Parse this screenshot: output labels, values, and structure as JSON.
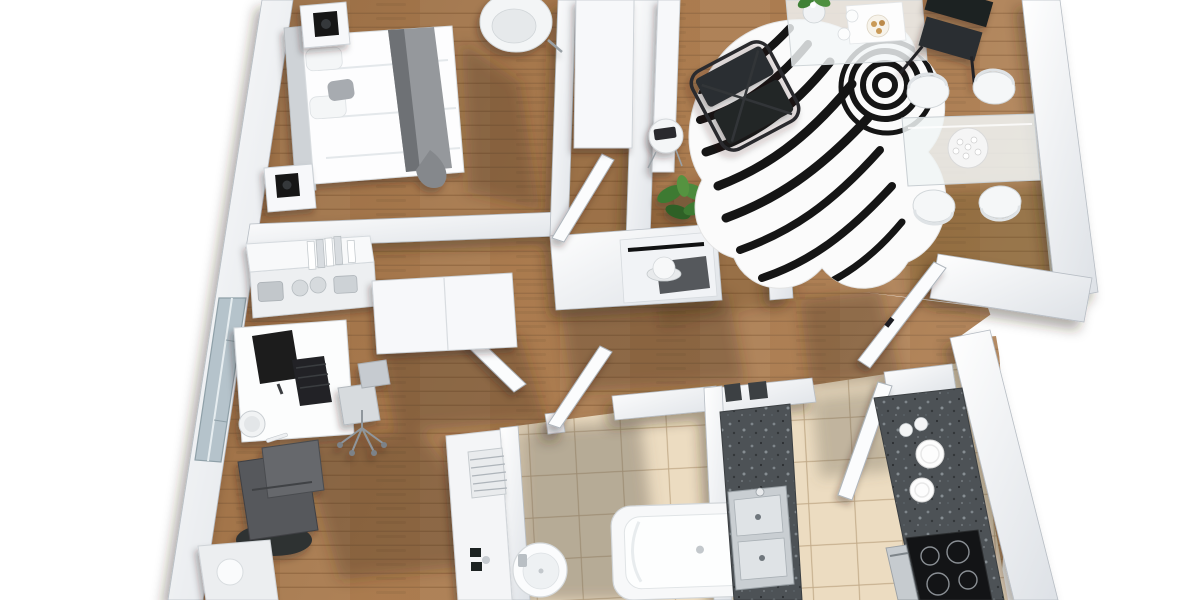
{
  "meta": {
    "title": "3D apartment floor plan render",
    "view": "top-down perspective, no visible text or UI chrome",
    "background": "#ffffff"
  },
  "colors": {
    "wood": "#ad7d50",
    "woodDark": "#8f6237",
    "tile": "#ecdcc1",
    "tileLine": "#c9b28b",
    "wall": "#f5f6f8",
    "wallEdge": "#b7bdc4",
    "granite": "#4d5256",
    "dark": "#1b1d1f",
    "chrome": "#aab1b7",
    "plant": "#3e7a33",
    "zebraBlack": "#151515",
    "shadowWood": "rgba(66,44,22,0.30)",
    "shadowTile": "rgba(104,96,82,0.40)"
  },
  "scene": {
    "rooms": [
      {
        "name": "bedroom",
        "floor": "wood",
        "furniture": [
          "double-bed-white-duvet",
          "gray-throw-blanket",
          "pillows",
          "upholstered-headboard",
          "nightstand-with-black-lamp-x2",
          "white-armchair"
        ]
      },
      {
        "name": "home-office",
        "floor": "wood",
        "furniture": [
          "white-desk",
          "monitor",
          "keyboard",
          "desk-bowl",
          "office-chair",
          "wall-shelf-with-binders-and-baskets",
          "wardrobe-with-open-door",
          "dark-lounge-chair",
          "low-cabinet",
          "window-in-west-wall"
        ]
      },
      {
        "name": "living-room",
        "floor": "wood",
        "furniture": [
          "zebra-hide-rug",
          "glass-coffee-table",
          "flower-vase",
          "serving-tray-with-plate-and-cups",
          "black-tubular-lounge-chair",
          "black-folding-chair",
          "potted-plant",
          "wall-console",
          "round-side-table"
        ]
      },
      {
        "name": "dining-area",
        "floor": "wood",
        "furniture": [
          "glass-dining-table",
          "white-shell-chair-x4",
          "coral-centerpiece"
        ]
      },
      {
        "name": "entry-hall",
        "floor": "wood",
        "furniture": [
          "hall-cabinet",
          "coat-rail",
          "white-hat",
          "dark-doormat",
          "open-door-x2"
        ]
      },
      {
        "name": "bathroom",
        "floor": "tile",
        "furniture": [
          "bathtub",
          "round-wall-basin",
          "towel-radiator",
          "utility-counter-with-faucet",
          "open-door"
        ]
      },
      {
        "name": "kitchen",
        "floor": "tile",
        "furniture": [
          "granite-counter-left-with-double-sink",
          "granite-counter-right",
          "black-cooktop-4-burners",
          "oven-front",
          "white-plates-x2",
          "cups-x2",
          "pass-through-hatch",
          "open-door"
        ]
      }
    ]
  }
}
